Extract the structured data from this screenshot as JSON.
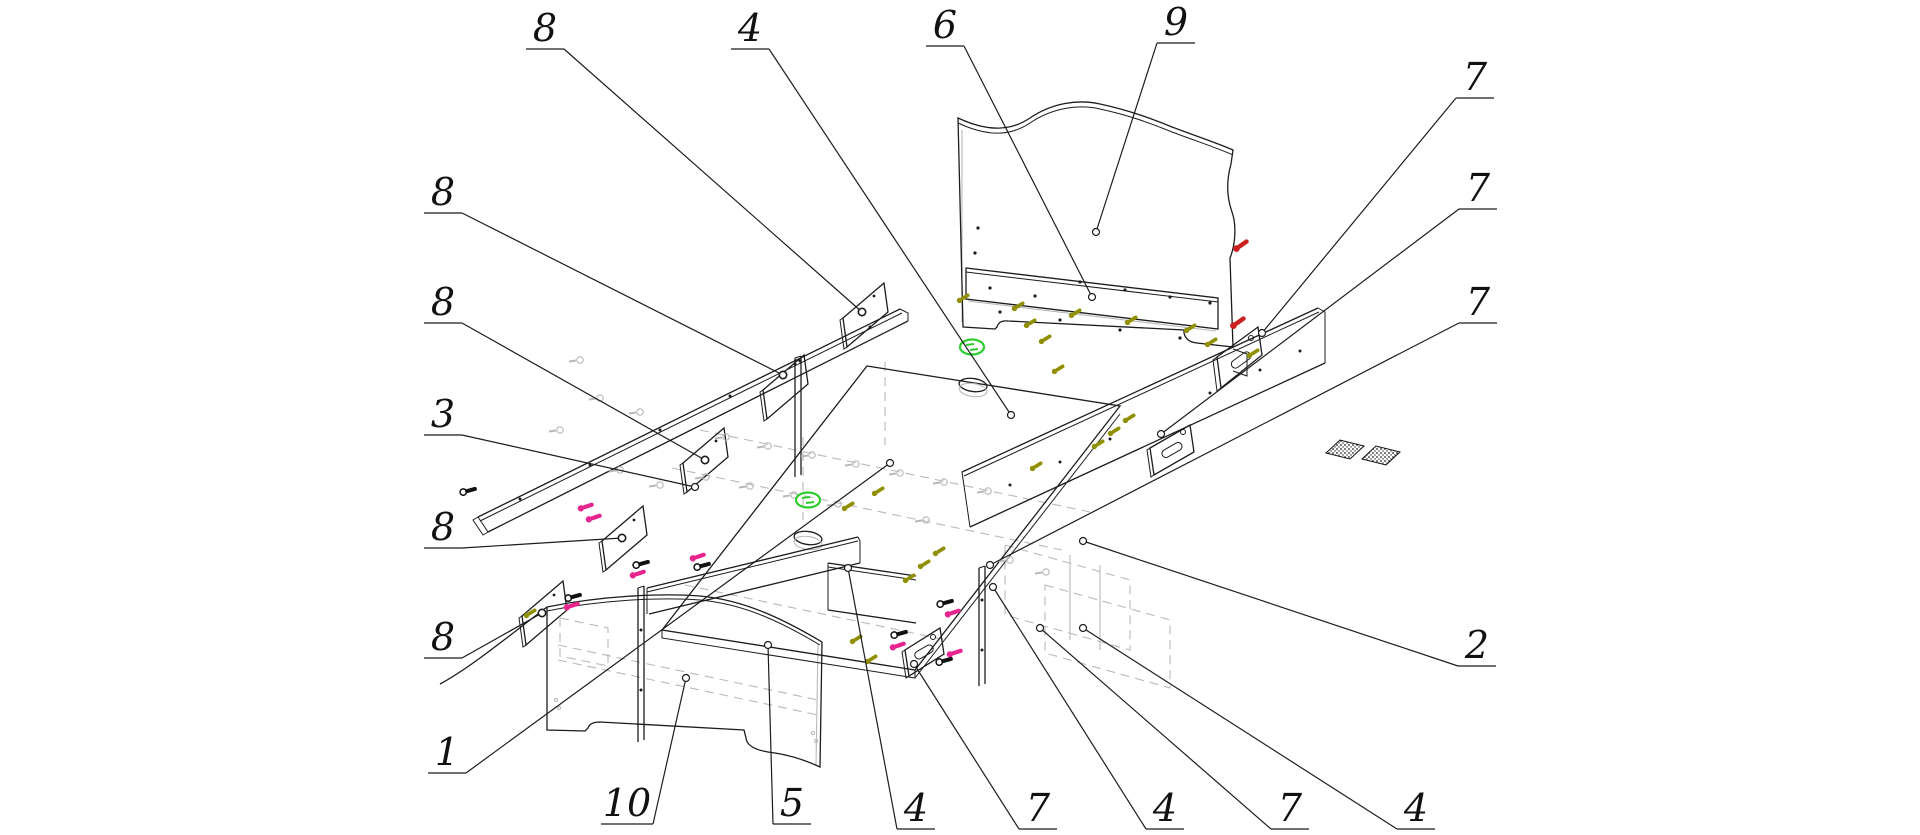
{
  "figure": {
    "kind": "exploded-assembly-diagram",
    "subject": "bed-with-drawers",
    "background": "#ffffff",
    "width": 1920,
    "height": 835
  },
  "colors": {
    "line": "#1c1c1c",
    "hidden_grey": "#b9b9b9",
    "cam_green": "#2ecc2e",
    "screw_red": "#cc2020",
    "screw_magenta": "#e8258f",
    "screw_olive": "#8f8f00",
    "screw_black": "#111111",
    "label_ink": "#111111"
  },
  "callouts": [
    {
      "label": "8",
      "lx": 545,
      "ly": 28,
      "tx": 862,
      "ty": 312
    },
    {
      "label": "4",
      "lx": 750,
      "ly": 28,
      "tx": 1011,
      "ty": 415
    },
    {
      "label": "6",
      "lx": 945,
      "ly": 25,
      "tx": 1092,
      "ty": 297
    },
    {
      "label": "9",
      "lx": 1176,
      "ly": 22,
      "tx": 1096,
      "ty": 232
    },
    {
      "label": "7",
      "lx": 1475,
      "ly": 77,
      "tx": 1262,
      "ty": 333
    },
    {
      "label": "7",
      "lx": 1478,
      "ly": 188,
      "tx": 1161,
      "ty": 434
    },
    {
      "label": "7",
      "lx": 1478,
      "ly": 302,
      "tx": 990,
      "ty": 565
    },
    {
      "label": "2",
      "lx": 1477,
      "ly": 645,
      "tx": 1083,
      "ty": 541
    },
    {
      "label": "8",
      "lx": 443,
      "ly": 192,
      "tx": 783,
      "ty": 375
    },
    {
      "label": "8",
      "lx": 443,
      "ly": 302,
      "tx": 705,
      "ty": 460
    },
    {
      "label": "3",
      "lx": 443,
      "ly": 414,
      "tx": 695,
      "ty": 487
    },
    {
      "label": "8",
      "lx": 443,
      "ly": 527,
      "tx": 622,
      "ty": 538
    },
    {
      "label": "8",
      "lx": 443,
      "ly": 637,
      "tx": 542,
      "ty": 613
    },
    {
      "label": "1",
      "lx": 447,
      "ly": 752,
      "tx": 890,
      "ty": 463
    },
    {
      "label": "10",
      "lx": 627,
      "ly": 803,
      "tx": 686,
      "ty": 678
    },
    {
      "label": "5",
      "lx": 792,
      "ly": 803,
      "tx": 768,
      "ty": 645
    },
    {
      "label": "4",
      "lx": 916,
      "ly": 808,
      "tx": 848,
      "ty": 568
    },
    {
      "label": "7",
      "lx": 1038,
      "ly": 808,
      "tx": 914,
      "ty": 664
    },
    {
      "label": "4",
      "lx": 1165,
      "ly": 808,
      "tx": 993,
      "ty": 587
    },
    {
      "label": "7",
      "lx": 1290,
      "ly": 808,
      "tx": 1040,
      "ty": 628
    },
    {
      "label": "4",
      "lx": 1416,
      "ly": 808,
      "tx": 1083,
      "ty": 628
    }
  ],
  "hardware": {
    "green_cams": [
      [
        972,
        347
      ],
      [
        808,
        500
      ]
    ],
    "red_screws": [
      [
        1243,
        244
      ],
      [
        1240,
        321
      ]
    ],
    "magenta_screws": [
      [
        588,
        506
      ],
      [
        596,
        517
      ],
      [
        574,
        605
      ],
      [
        640,
        573
      ],
      [
        700,
        556
      ],
      [
        955,
        612
      ],
      [
        900,
        645
      ],
      [
        957,
        652
      ]
    ],
    "olive_screws": [
      [
        965,
        297
      ],
      [
        1020,
        305
      ],
      [
        1077,
        312
      ],
      [
        1133,
        319
      ],
      [
        1192,
        327
      ],
      [
        1213,
        341
      ],
      [
        1032,
        322
      ],
      [
        1047,
        338
      ],
      [
        1060,
        368
      ],
      [
        1100,
        443
      ],
      [
        1116,
        430
      ],
      [
        1131,
        417
      ],
      [
        1038,
        465
      ],
      [
        911,
        577
      ],
      [
        926,
        563
      ],
      [
        941,
        550
      ],
      [
        858,
        638
      ],
      [
        873,
        658
      ],
      [
        532,
        612
      ],
      [
        1255,
        352
      ],
      [
        880,
        490
      ],
      [
        850,
        505
      ]
    ],
    "black_screws": [
      [
        576,
        596
      ],
      [
        644,
        563
      ],
      [
        705,
        565
      ],
      [
        948,
        602
      ],
      [
        902,
        633
      ],
      [
        947,
        660
      ],
      [
        471,
        490
      ]
    ],
    "grey_fittings": [
      [
        726,
        437
      ],
      [
        768,
        446
      ],
      [
        812,
        455
      ],
      [
        856,
        464
      ],
      [
        900,
        473
      ],
      [
        944,
        482
      ],
      [
        988,
        491
      ],
      [
        706,
        477
      ],
      [
        750,
        486
      ],
      [
        794,
        495
      ],
      [
        838,
        504
      ],
      [
        926,
        520
      ],
      [
        1010,
        560
      ],
      [
        1046,
        572
      ],
      [
        600,
        398
      ],
      [
        640,
        412
      ],
      [
        560,
        430
      ],
      [
        620,
        470
      ],
      [
        660,
        485
      ],
      [
        580,
        360
      ]
    ]
  }
}
